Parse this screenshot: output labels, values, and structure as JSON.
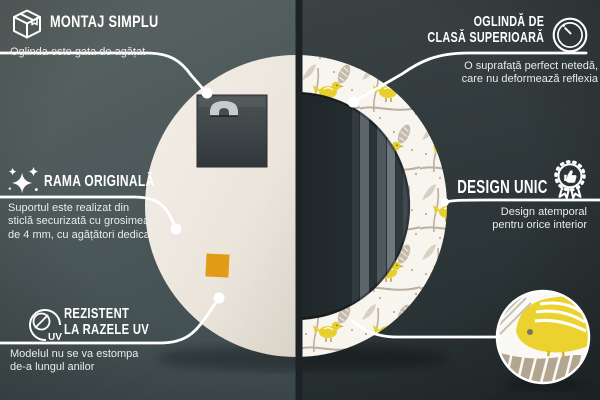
{
  "product": {
    "name": "Oglindă rotundă decorativă cu model de păsări",
    "views": {
      "left_half": "mirror-back-view",
      "right_half": "mirror-front-view-with-birds-frame",
      "detail_circle": "pattern-zoom-detail"
    },
    "colors": {
      "background_left": "#4e5a5b",
      "background_right": "#2c3537",
      "divider": "#1d2325",
      "back_cream": "#efe9e1",
      "sticker_orange": "#e29b16",
      "pattern_yellow": "#e7cf2e",
      "pattern_gray": "#b9b0a1",
      "mirror_dark": "#1d2426",
      "callout_line": "#ffffff"
    }
  },
  "callouts": [
    {
      "icon": "package-box-icon",
      "title": "MONTAJ SIMPLU",
      "description": "Oglinda este gata de agățat"
    },
    {
      "icon": "round-mirror-icon",
      "title_line1": "OGLINDĂ DE",
      "title_line2": "CLASĂ SUPERIOARĂ",
      "description": "O suprafață perfect netedă,\ncare nu deformează reflexia"
    },
    {
      "icon": "sparkles-icon",
      "title": "RAMA ORIGINALĂ",
      "description": "Suportul este realizat din\nsticlă securizată cu grosimea\nde 4 mm, cu agățători dedicate"
    },
    {
      "icon": "award-badge-icon",
      "title": "DESIGN UNIC",
      "description": "Design atemporal\npentru orice interior"
    },
    {
      "icon": "uv-sun-icon",
      "icon_label": "UV",
      "title_line1": "REZISTENT",
      "title_line2": "LA RAZELE UV",
      "description": "Modelul nu se va estompa\nde-a lungul anilor"
    }
  ]
}
